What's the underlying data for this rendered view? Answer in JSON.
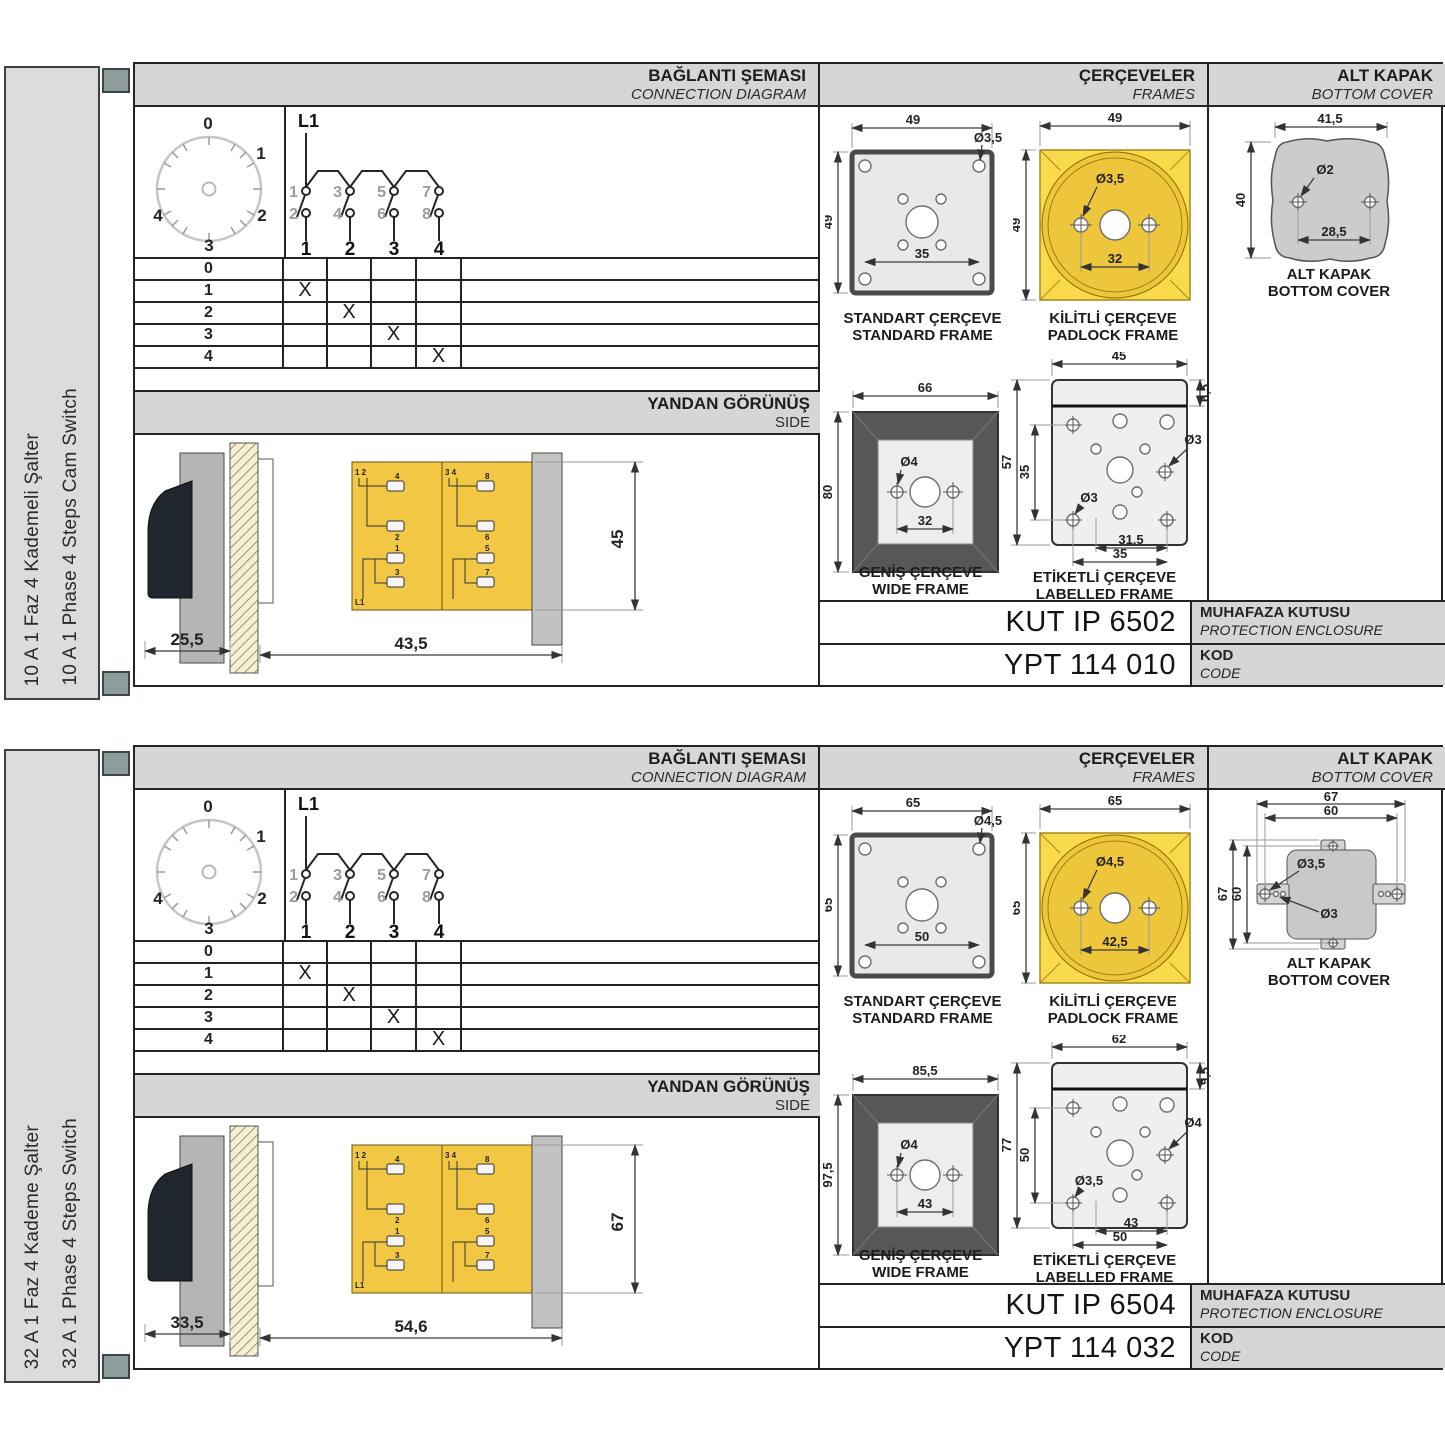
{
  "panels": [
    {
      "sidebar_tr": "10 A 1 Faz 4 Kademeli Şalter",
      "sidebar_en": "10 A 1 Phase 4 Steps Cam Switch",
      "headers": {
        "connection_tr": "BAĞLANTI ŞEMASI",
        "connection_en": "CONNECTION DIAGRAM",
        "frames_tr": "ÇERÇEVELER",
        "frames_en": "FRAMES",
        "cover_tr": "ALT KAPAK",
        "cover_en": "BOTTOM COVER",
        "side_tr": "YANDAN GÖRÜNÜŞ",
        "side_en": "SIDE"
      },
      "dial": [
        "0",
        "1",
        "2",
        "3",
        "4"
      ],
      "circuit": {
        "l1": "L1",
        "top": [
          "1",
          "3",
          "5",
          "7"
        ],
        "bottom": [
          "2",
          "4",
          "6",
          "8"
        ],
        "out": [
          "1",
          "2",
          "3",
          "4"
        ]
      },
      "table": {
        "rows": [
          "0",
          "1",
          "2",
          "3",
          "4"
        ],
        "x": "X"
      },
      "side_view": {
        "m1": "1 2",
        "m2": "3 4",
        "l1": "L1",
        "t4": "4",
        "t2": "2",
        "t1": "1",
        "t3": "3",
        "t8": "8",
        "t6": "6",
        "t5": "5",
        "t7": "7",
        "dim_a": "25,5",
        "dim_b": "43,5",
        "dim_h": "45"
      },
      "frames": {
        "standard": {
          "tr": "STANDART ÇERÇEVE",
          "en": "STANDARD FRAME",
          "w": "49",
          "h": "49",
          "hole": "Ø3,5",
          "c": "35"
        },
        "padlock": {
          "tr": "KİLİTLİ ÇERÇEVE",
          "en": "PADLOCK FRAME",
          "w": "49",
          "h": "49",
          "hole": "Ø3,5",
          "c": "32"
        },
        "wide": {
          "tr": "GENİŞ ÇERÇEVE",
          "en": "WIDE FRAME",
          "w": "66",
          "h": "80",
          "hole": "Ø4",
          "c": "32"
        },
        "labelled": {
          "tr": "ETİKETLİ ÇERÇEVE",
          "en": "LABELLED FRAME",
          "w": "45",
          "strip": "6,5",
          "h": "57",
          "ih": "35",
          "holeR": "Ø3",
          "holeB": "Ø3",
          "b1": "31,5",
          "b2": "35"
        }
      },
      "cover": {
        "tr": "ALT KAPAK",
        "en": "BOTTOM COVER",
        "w": "41,5",
        "h": "40",
        "hole": "Ø2",
        "c": "28,5"
      },
      "codes": {
        "enclosure": "KUT IP 6502",
        "enclosure_tr": "MUHAFAZA KUTUSU",
        "enclosure_en": "PROTECTION ENCLOSURE",
        "code": "YPT 114 010",
        "code_tr": "KOD",
        "code_en": "CODE"
      }
    },
    {
      "sidebar_tr": "32 A 1 Faz 4 Kademe Şalter",
      "sidebar_en": "32 A 1 Phase 4 Steps Switch",
      "headers": {
        "connection_tr": "BAĞLANTI ŞEMASI",
        "connection_en": "CONNECTION DIAGRAM",
        "frames_tr": "ÇERÇEVELER",
        "frames_en": "FRAMES",
        "cover_tr": "ALT KAPAK",
        "cover_en": "BOTTOM COVER",
        "side_tr": "YANDAN GÖRÜNÜŞ",
        "side_en": "SIDE"
      },
      "dial": [
        "0",
        "1",
        "2",
        "3",
        "4"
      ],
      "circuit": {
        "l1": "L1",
        "top": [
          "1",
          "3",
          "5",
          "7"
        ],
        "bottom": [
          "2",
          "4",
          "6",
          "8"
        ],
        "out": [
          "1",
          "2",
          "3",
          "4"
        ]
      },
      "table": {
        "rows": [
          "0",
          "1",
          "2",
          "3",
          "4"
        ],
        "x": "X"
      },
      "side_view": {
        "m1": "1 2",
        "m2": "3 4",
        "l1": "L1",
        "t4": "4",
        "t2": "2",
        "t1": "1",
        "t3": "3",
        "t8": "8",
        "t6": "6",
        "t5": "5",
        "t7": "7",
        "dim_a": "33,5",
        "dim_b": "54,6",
        "dim_h": "67"
      },
      "frames": {
        "standard": {
          "tr": "STANDART ÇERÇEVE",
          "en": "STANDARD FRAME",
          "w": "65",
          "h": "65",
          "hole": "Ø4,5",
          "c": "50"
        },
        "padlock": {
          "tr": "KİLİTLİ ÇERÇEVE",
          "en": "PADLOCK FRAME",
          "w": "65",
          "h": "65",
          "hole": "Ø4,5",
          "c": "42,5"
        },
        "wide": {
          "tr": "GENİŞ ÇERÇEVE",
          "en": "WIDE FRAME",
          "w": "85,5",
          "h": "97,5",
          "hole": "Ø4",
          "c": "43"
        },
        "labelled": {
          "tr": "ETİKETLİ ÇERÇEVE",
          "en": "LABELLED FRAME",
          "w": "62",
          "strip": "9,5",
          "h": "77",
          "ih": "50",
          "holeR": "Ø4",
          "holeB": "Ø3,5",
          "b1": "43",
          "b2": "50"
        }
      },
      "cover": {
        "tr": "ALT KAPAK",
        "en": "BOTTOM COVER",
        "w1": "67",
        "w2": "60",
        "h1": "67",
        "h2": "60",
        "holeTab": "Ø3,5",
        "holeSm": "Ø3"
      },
      "codes": {
        "enclosure": "KUT IP 6504",
        "enclosure_tr": "MUHAFAZA KUTUSU",
        "enclosure_en": "PROTECTION ENCLOSURE",
        "code": "YPT 114 032",
        "code_tr": "KOD",
        "code_en": "CODE"
      }
    }
  ]
}
